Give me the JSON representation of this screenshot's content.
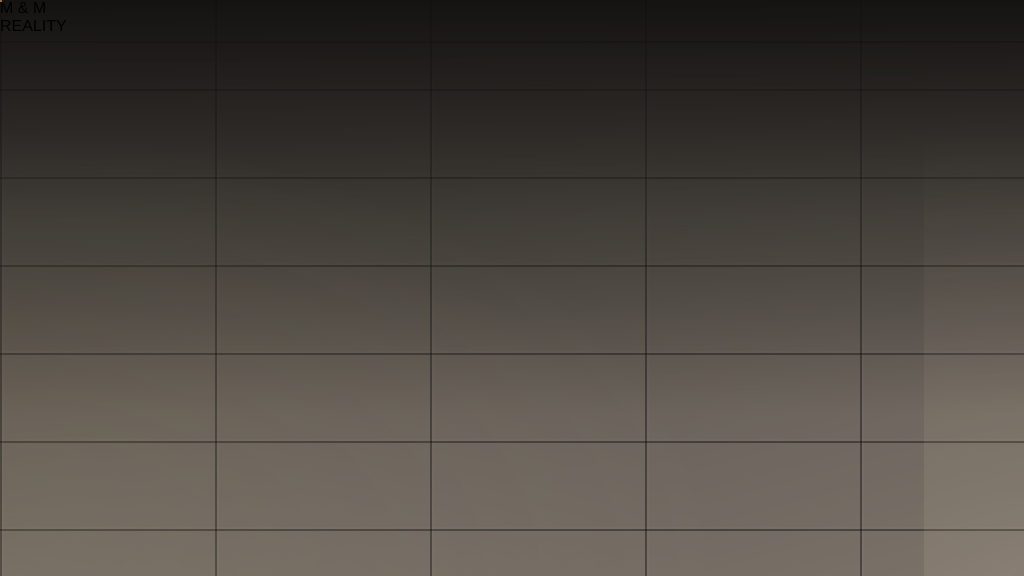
{
  "brand": {
    "logo_m_left": "M",
    "logo_ampersand": "&",
    "logo_m_right": "M",
    "logo_subtitle": "REALITY",
    "logo_red": "#d6232b",
    "logo_blue": "#1878c8"
  },
  "palette": {
    "background_tile": "#5d564e",
    "wall_black": "#16110c",
    "living_floor": "#8b8071",
    "bedroom_floor": "#a6957d",
    "hall_tile_gray": "#93928e",
    "entry_tile_terracotta": "#9a5737",
    "bath_tile_beige": "#9c9080",
    "balcony_hex_orange": "#d28f3c",
    "sofa_red": "#cd2917",
    "door_wood_tan": "#dca855",
    "furniture_white": "#f3f1ec",
    "bedding_cream": "#ebe2cb"
  }
}
